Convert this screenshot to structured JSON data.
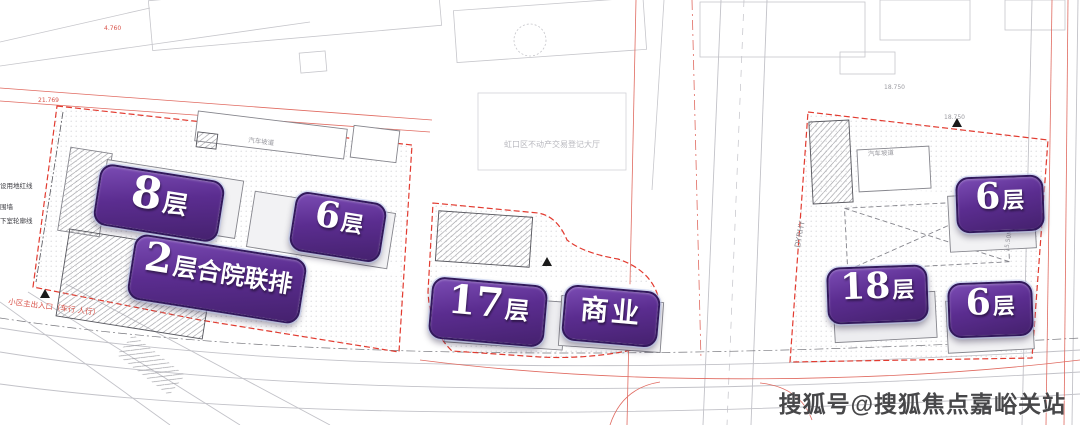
{
  "page": {
    "watermark": "搜狐号@搜狐焦点嘉峪关站"
  },
  "plan": {
    "hall": "虹口区不动产交易登记大厅",
    "entrance": "小区主出入口（车行 人行）",
    "ramp": "汽车坡道",
    "road_tag": "DYRHY",
    "legend": {
      "red_line": "设用地红线",
      "wall": "围墙",
      "basement": "下室轮廓线"
    },
    "marks": {
      "m1": "4.760",
      "m2": "21.769",
      "m3": "18.750",
      "m4": "18.750",
      "m5": "15.50M"
    }
  },
  "labels": [
    {
      "big": "8",
      "small": "层"
    },
    {
      "big": "6",
      "small": "层"
    },
    {
      "big": "2",
      "small": "层合院联排"
    },
    {
      "big": "17",
      "small": "层"
    },
    {
      "big": "",
      "small": "商业"
    },
    {
      "big": "6",
      "small": "层"
    },
    {
      "big": "18",
      "small": "层"
    },
    {
      "big": "6",
      "small": "层"
    }
  ],
  "colors": {
    "label_purple": "#5b2d90",
    "label_border": "#32195c",
    "boundary_red": "#e23b30",
    "thin_red": "#e06a60",
    "line_gray": "#c6c6cb",
    "hatch_gray": "#8f8f95"
  }
}
